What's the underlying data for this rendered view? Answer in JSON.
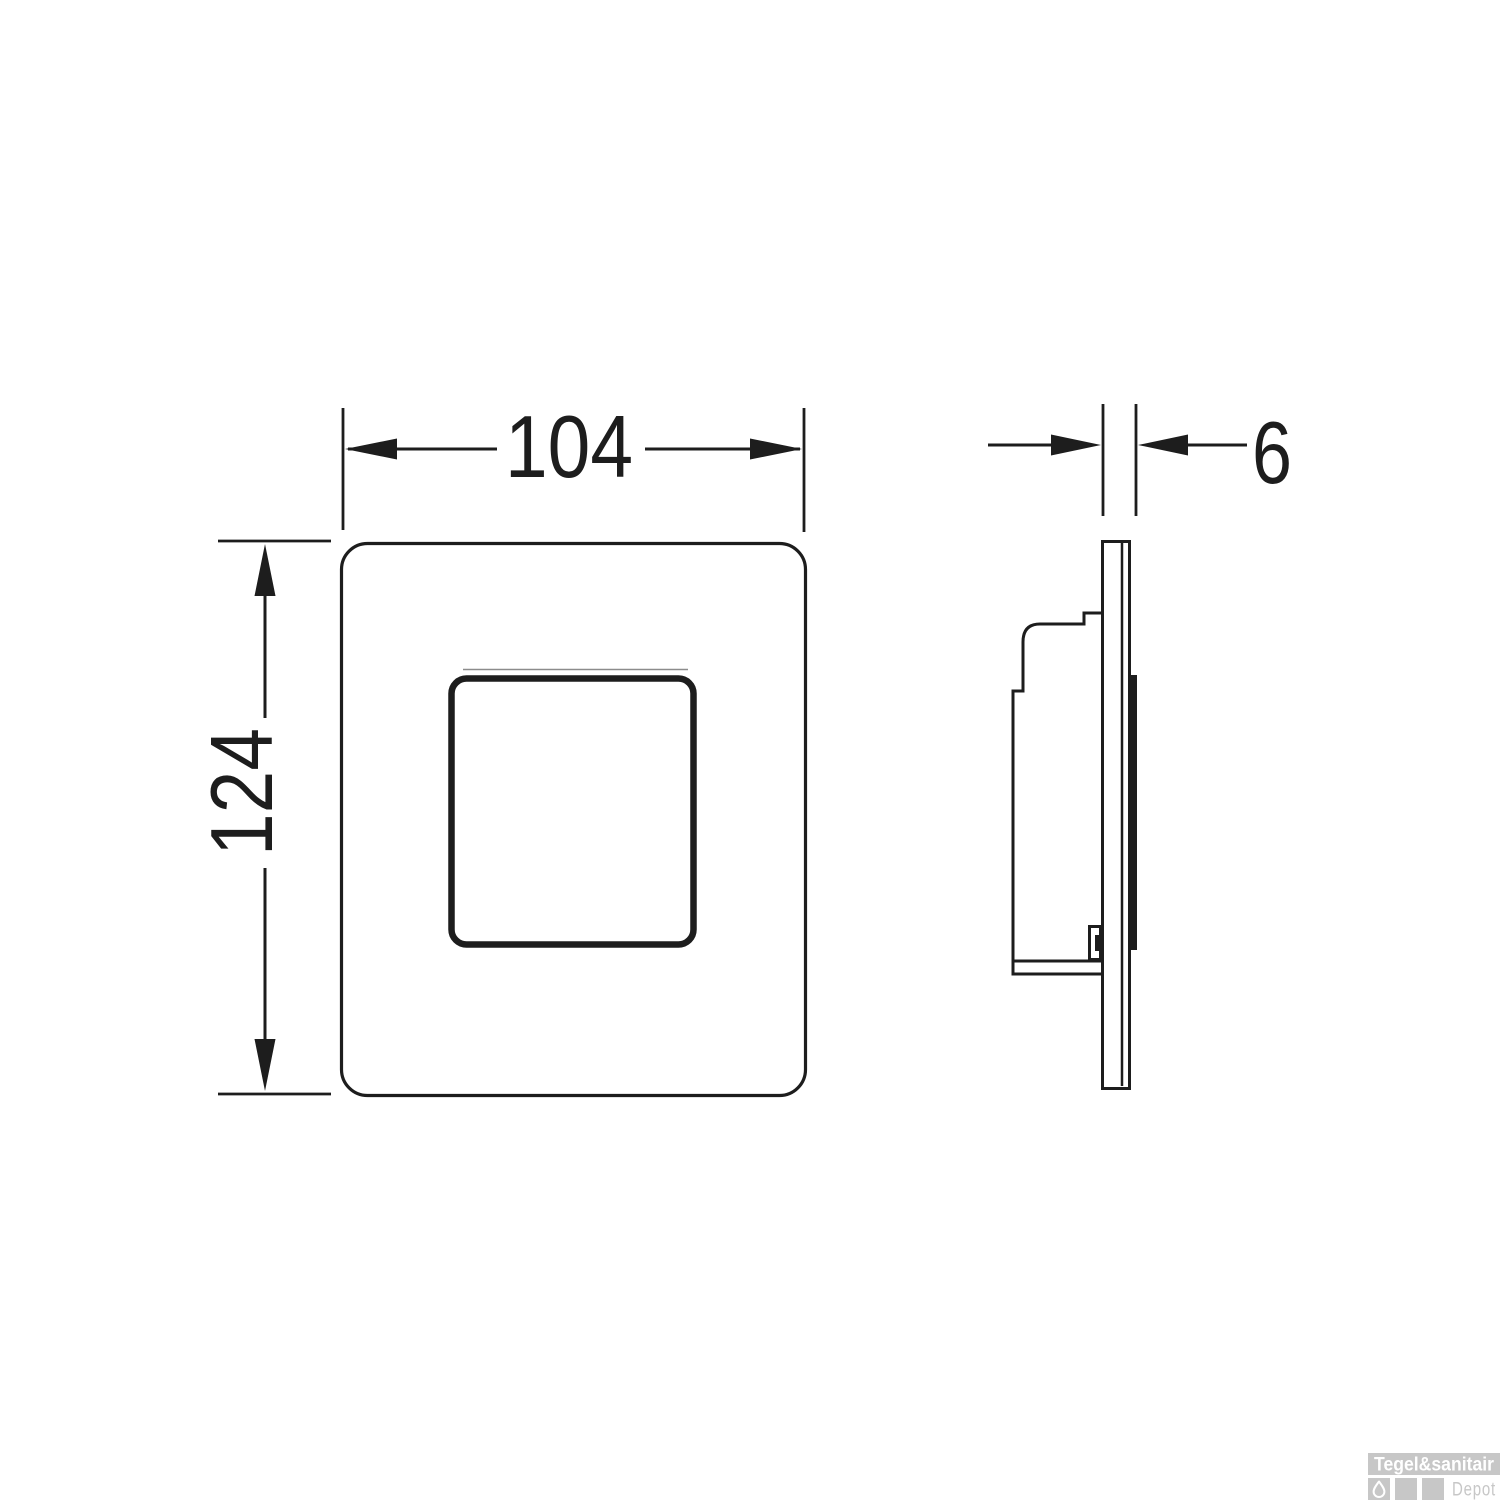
{
  "drawing": {
    "line_color": "#1d1d1d",
    "dimensions": {
      "width": {
        "value": "104"
      },
      "height": {
        "value": "124"
      },
      "depth": {
        "value": "6"
      }
    }
  },
  "watermark": {
    "brand": "Tegel&sanitair",
    "sub": "Depot",
    "banner_color": "#c7c7c7",
    "brand_text_color": "#ffffff",
    "sub_text_color": "#c7c7c7"
  }
}
